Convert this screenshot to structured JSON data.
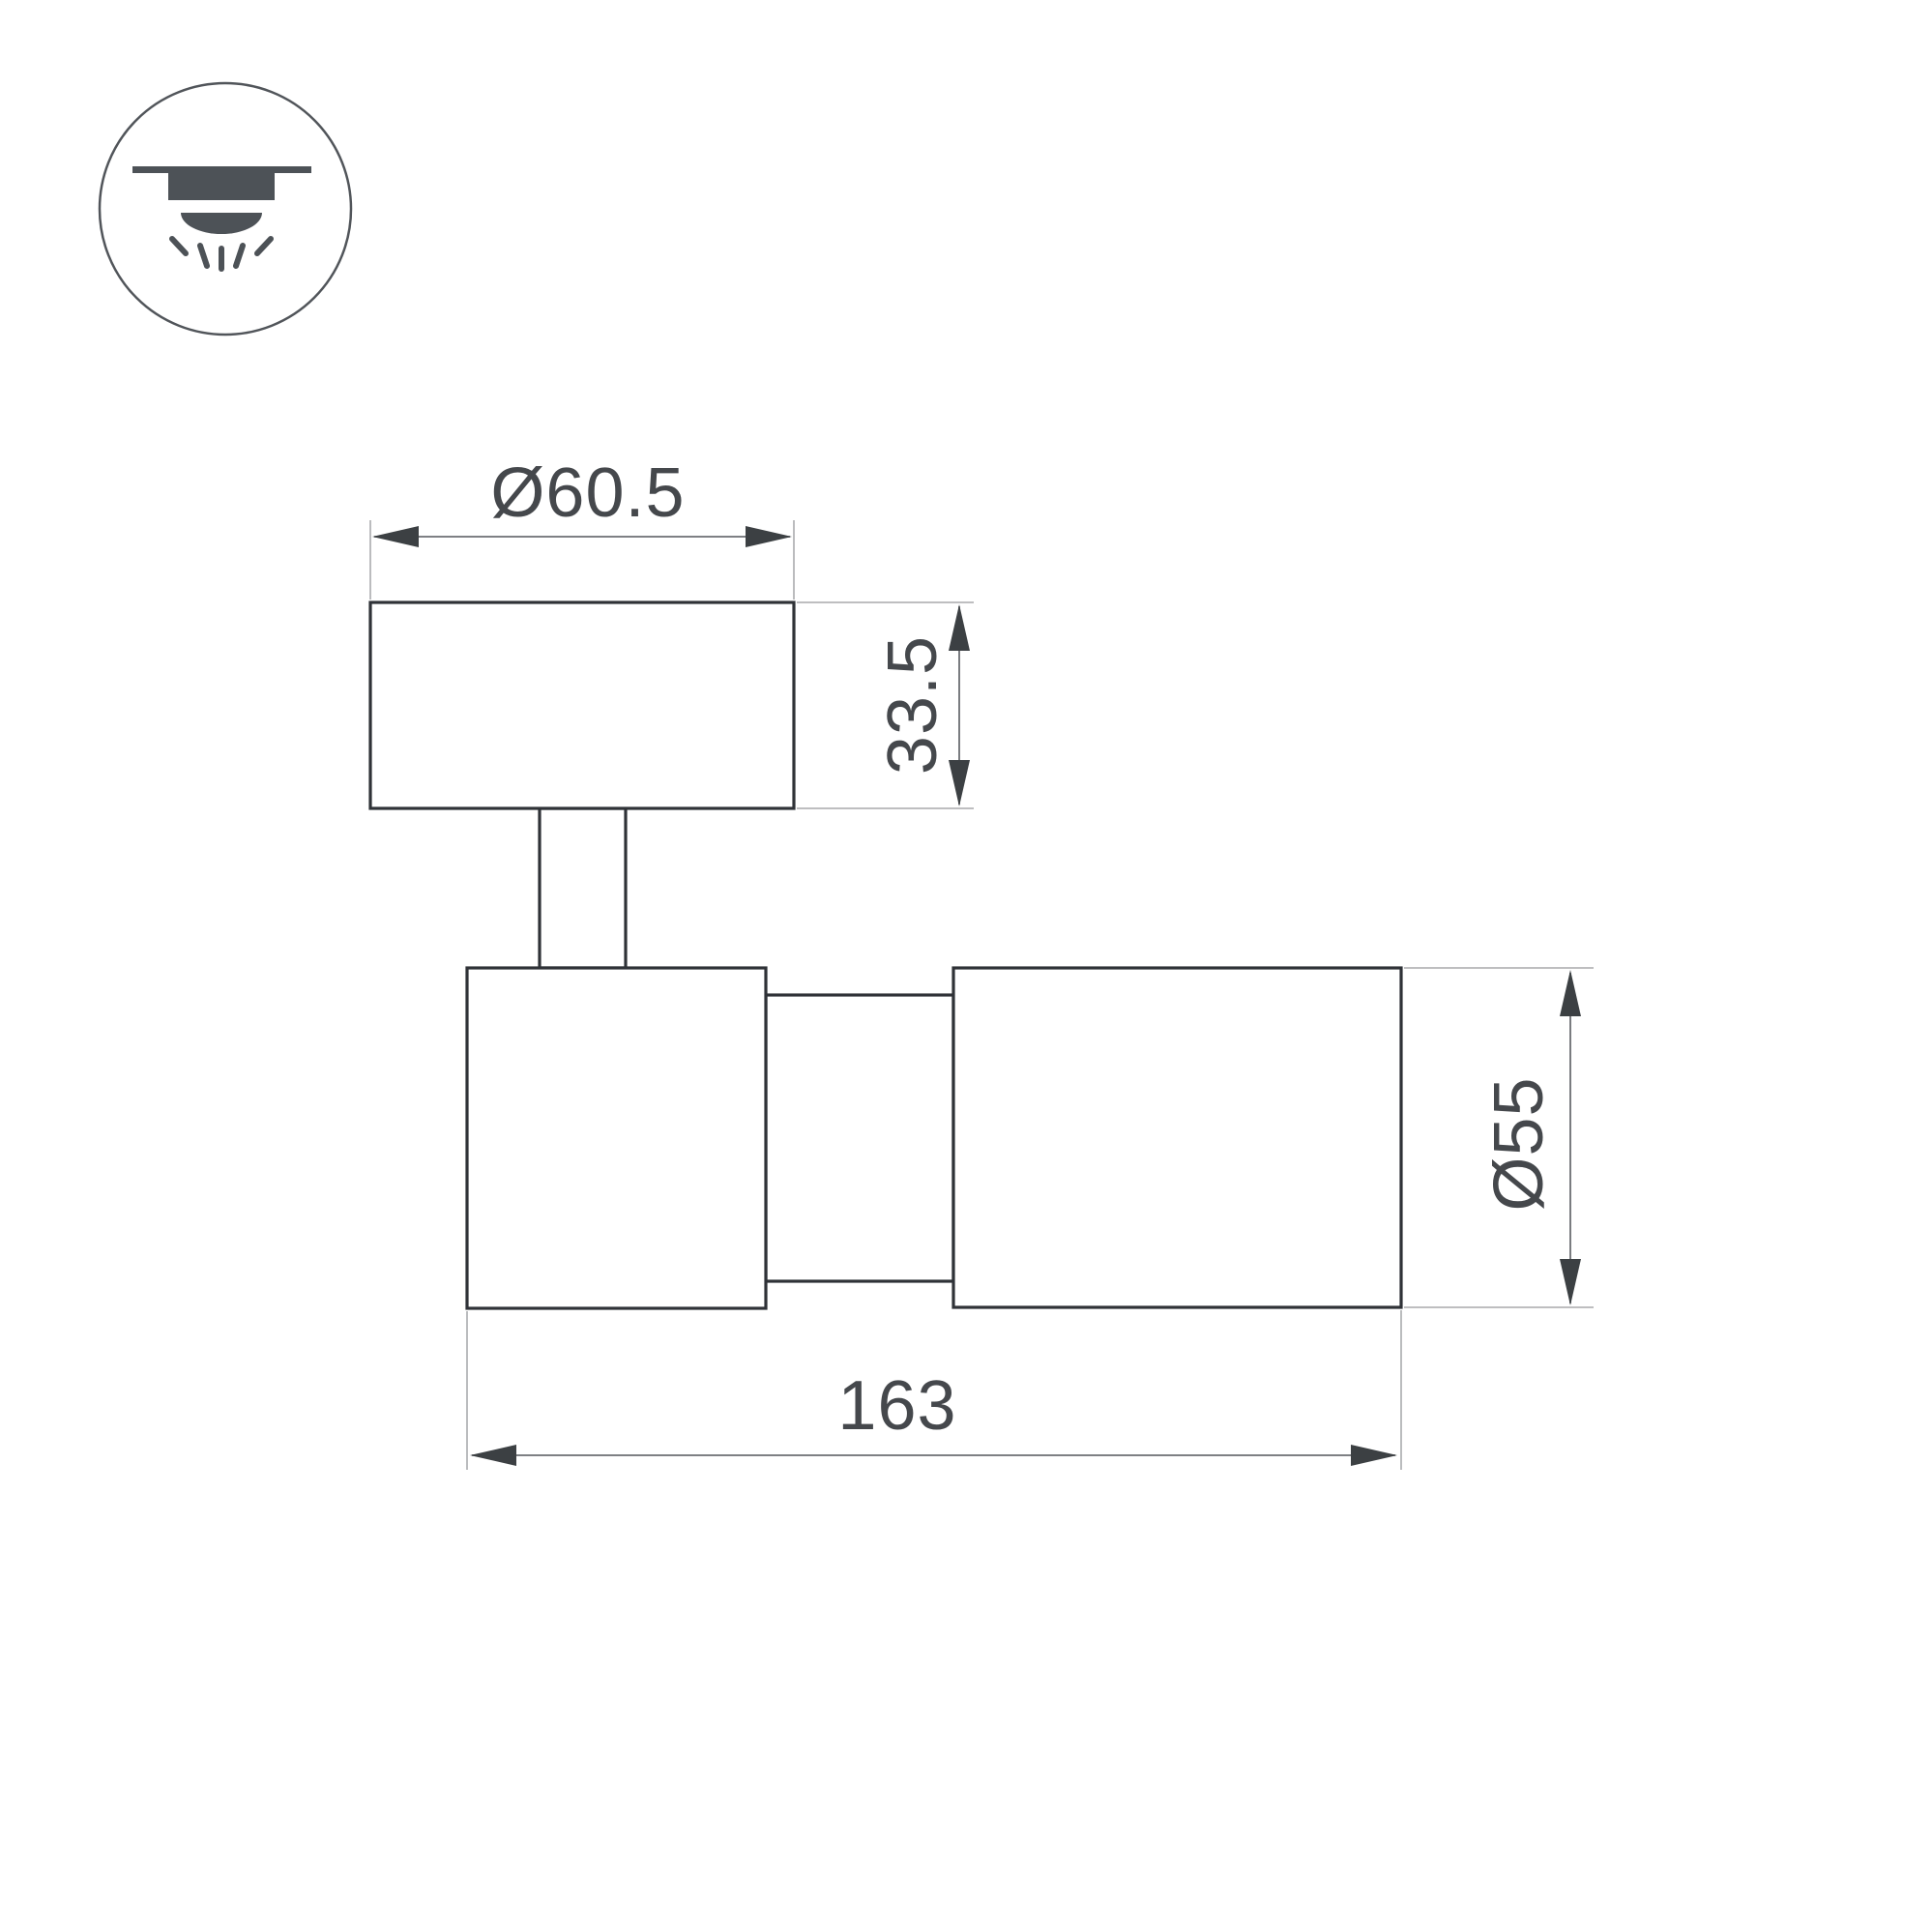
{
  "page": {
    "background_color": "#ffffff",
    "content": "technical dimension drawing of a surface ceiling spot luminaire, side view"
  },
  "icon": {
    "name": "ceiling-mounted-downlight",
    "description": "circle badge with recessed ceiling light emitting rays downward",
    "stroke_color": "#51555a",
    "fill_color": "#4d5257"
  },
  "drawing": {
    "outline_color": "#2f3237",
    "dimension_line_color": "#6b6e72",
    "extension_line_color": "#96989b",
    "label_color": "#45484c",
    "dimensions": {
      "mount_diameter": {
        "label": "Ø60.5",
        "value": 60.5
      },
      "mount_height": {
        "label": "33.5",
        "value": 33.5
      },
      "body_diameter": {
        "label": "Ø55",
        "value": 55
      },
      "overall_length": {
        "label": "163",
        "value": 163
      }
    }
  }
}
